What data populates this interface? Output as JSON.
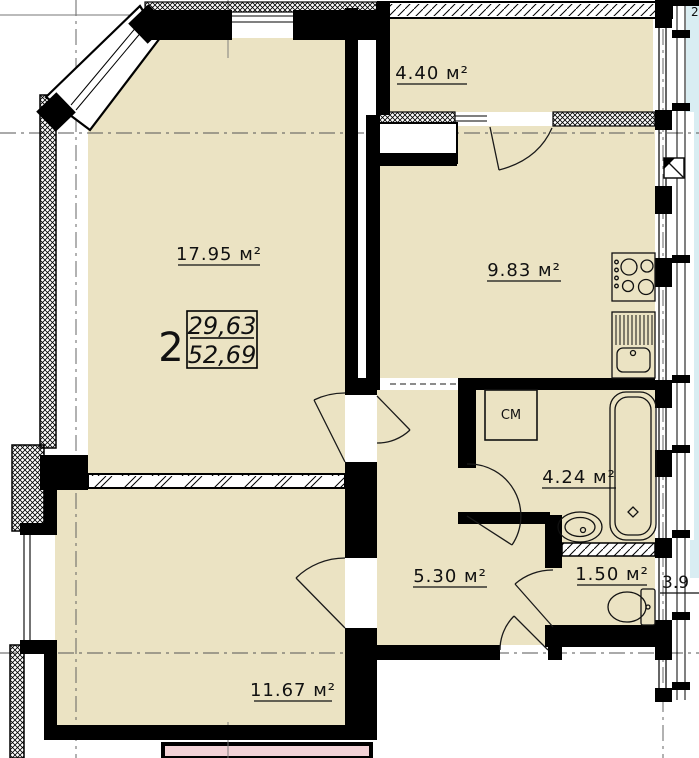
{
  "drawing": {
    "apartment": {
      "number": "2",
      "area_upper": "29,63",
      "area_lower": "52,69"
    },
    "rooms": [
      {
        "name": "living-room",
        "label": "17.95 м²"
      },
      {
        "name": "kitchen",
        "label": "9.83 м²"
      },
      {
        "name": "balcony",
        "label": "4.40 м²"
      },
      {
        "name": "bathroom",
        "label": "4.24 м²"
      },
      {
        "name": "hallway",
        "label": "5.30 м²"
      },
      {
        "name": "wc",
        "label": "1.50 м²"
      },
      {
        "name": "bedroom",
        "label": "11.67 м²"
      }
    ],
    "annotations": {
      "washing_machine": "СМ",
      "adjacent_area_partial": "3.9",
      "corner_partial": "2"
    },
    "colors": {
      "room_fill": "#EBE3C3",
      "adjacent_pink": "#F3D2D6",
      "adjacent_blue": "#D9EDF2",
      "wall": "#000000"
    }
  }
}
